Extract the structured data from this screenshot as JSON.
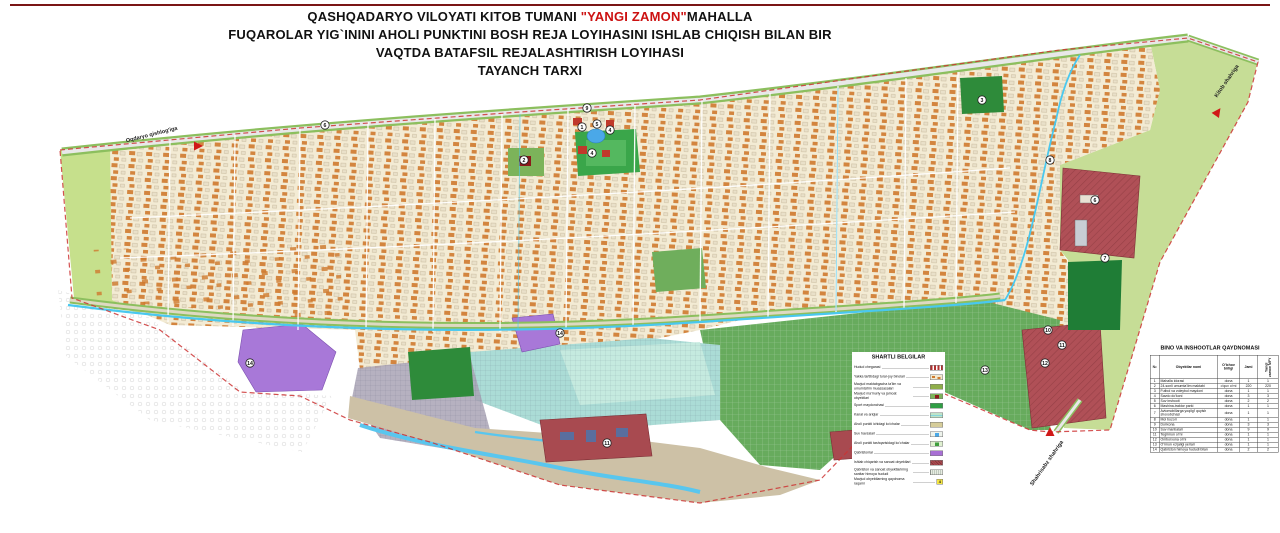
{
  "title": {
    "line1_prefix": "QASHQADARYO VILOYATI KITOB TUMANI ",
    "line1_highlight": "\"YANGI ZAMON\"",
    "line1_suffix": "MAHALLA",
    "line2": "FUQAROLAR YIG`ININI AHOLI PUNKTINI BOSH REJA LOYIHASINI ISHLAB CHIQISH BILAN BIR",
    "line3": "VAQTDA BATAFSIL REJALASHTIRISH LOYIHASI",
    "line4": "TAYANCH TARXI",
    "highlight_color": "#cc1111"
  },
  "legend": {
    "title": "SHARTLI BELGILAR",
    "items": [
      {
        "label": "Hudud chegarasi",
        "swatch": {
          "bg": "#ffffff",
          "pattern": "dashes",
          "color": "#b03030"
        }
      },
      {
        "label": "Yakka tartibdagi turar-joy binolari",
        "swatch": {
          "bg": "#f2e9d0",
          "pattern": "houses",
          "color": "#cf7a2e"
        }
      },
      {
        "label": "Mavjud maktabgacha ta'lim va umumta'lim muassasalari",
        "swatch": {
          "bg": "#8fae4a"
        }
      },
      {
        "label": "Mavjud ma'muriy va jamoat obyektlari",
        "swatch": {
          "bg": "#7cb35a",
          "inner": "#8b1a1a"
        }
      },
      {
        "label": "Sport maydonchasi",
        "swatch": {
          "bg": "#2f9e44"
        }
      },
      {
        "label": "Kanal va ariqlar",
        "swatch": {
          "bg": "#bfe3c8",
          "pattern": "wave",
          "color": "#49c8ef"
        }
      },
      {
        "label": "Aholi punkti ichidagi ko'chalar",
        "swatch": {
          "bg": "#d6cd9a"
        }
      },
      {
        "label": "Suv havzalari",
        "swatch": {
          "bg": "#eef3ec",
          "inner": "#4aa8e8"
        }
      },
      {
        "label": "Aholi punkti tashqarisidagi ko'chalar",
        "swatch": {
          "bg": "#dff0d0",
          "inner": "#3f9e3f"
        }
      },
      {
        "label": "Qabristonlar",
        "swatch": {
          "bg": "#a86fd4"
        }
      },
      {
        "label": "Ishlab chiqarish va sanoat obyektlari",
        "swatch": {
          "bg": "#a84a50",
          "pattern": "hatch",
          "color": "#7c2f35"
        }
      },
      {
        "label": "Qabriston va sanoat obyektlarining sanitar himoya hududi",
        "swatch": {
          "bg": "#e7ece2",
          "pattern": "vhatch",
          "color": "#9aa79a"
        }
      },
      {
        "label": "Mavjud obyektlarning qaydnoma raqami",
        "swatch": {
          "number": "4",
          "numberBg": "#f5e642"
        }
      }
    ]
  },
  "table": {
    "title": "BINO VA INSHOOTLAR QAYDNOMASI",
    "col_no": "№",
    "col_name": "Obyektlar nomi",
    "col_unit": "O'lchov birligi",
    "col_total": "Jami",
    "col_mfy": "Yangi zamon MFY",
    "rows": [
      [
        "1",
        "Mahalla idorasi",
        "dona",
        "1",
        "1"
      ],
      [
        "2",
        "24-sonli umumta'lim maktabi",
        "o'quv o'rni",
        "220",
        "220"
      ],
      [
        "3",
        "Futbol va voleybol maydoni",
        "dona",
        "1",
        "1"
      ],
      [
        "4",
        "Savdo do'koni",
        "dona",
        "3",
        "3"
      ],
      [
        "5",
        "Suv inshooti",
        "dona",
        "2",
        "2"
      ],
      [
        "6",
        "Mashina-traktor parki",
        "dona",
        "1",
        "1"
      ],
      [
        "7",
        "Avtomobillarga yoqilg'i quyish shoxobchasi",
        "dona",
        "1",
        "1"
      ],
      [
        "8",
        "Mol bozori",
        "dona",
        "1",
        "1"
      ],
      [
        "9",
        "Dorixona",
        "dona",
        "3",
        "3"
      ],
      [
        "10",
        "Suv manbalari",
        "dona",
        "9",
        "9"
      ],
      [
        "11",
        "Tegirmon o'rni",
        "dona",
        "1",
        "1"
      ],
      [
        "12",
        "Omborxona o'rni",
        "dona",
        "1",
        "1"
      ],
      [
        "13",
        "O'rmon xo'jaligi yerlari",
        "dona",
        "1",
        "1"
      ],
      [
        "14",
        "Qabriston himoya hududi bilan",
        "dona",
        "2",
        "2"
      ]
    ]
  },
  "map": {
    "markers": [
      {
        "n": "6",
        "x": 325,
        "y": 125
      },
      {
        "n": "2",
        "x": 524,
        "y": 160
      },
      {
        "n": "9",
        "x": 587,
        "y": 108
      },
      {
        "n": "1",
        "x": 582,
        "y": 127
      },
      {
        "n": "5",
        "x": 597,
        "y": 124
      },
      {
        "n": "4",
        "x": 610,
        "y": 130
      },
      {
        "n": "4",
        "x": 592,
        "y": 153
      },
      {
        "n": "3",
        "x": 982,
        "y": 100
      },
      {
        "n": "8",
        "x": 1050,
        "y": 160
      },
      {
        "n": "6",
        "x": 1095,
        "y": 200
      },
      {
        "n": "7",
        "x": 1105,
        "y": 258
      },
      {
        "n": "10",
        "x": 1048,
        "y": 330
      },
      {
        "n": "11",
        "x": 1062,
        "y": 345
      },
      {
        "n": "12",
        "x": 1045,
        "y": 363
      },
      {
        "n": "13",
        "x": 985,
        "y": 370
      },
      {
        "n": "14",
        "x": 250,
        "y": 363
      },
      {
        "n": "14",
        "x": 560,
        "y": 333
      },
      {
        "n": "11",
        "x": 607,
        "y": 443
      }
    ],
    "direction_labels": [
      {
        "text": "Oqdaryo qishlog'iga",
        "x": 152,
        "y": 136,
        "angle": -14,
        "tx": 197,
        "ty": 146,
        "tr": 90
      },
      {
        "text": "Kitob shahriga",
        "x": 1228,
        "y": 82,
        "angle": -55,
        "tx": 1217,
        "ty": 113,
        "tr": 35
      },
      {
        "text": "Shahrisabz shahriga",
        "x": 1048,
        "y": 464,
        "angle": -55,
        "tx": 1050,
        "ty": 433,
        "tr": 0
      }
    ],
    "marker_fill": "#ffffff",
    "marker_stroke": "#222222",
    "triangle_color": "#d01818"
  }
}
